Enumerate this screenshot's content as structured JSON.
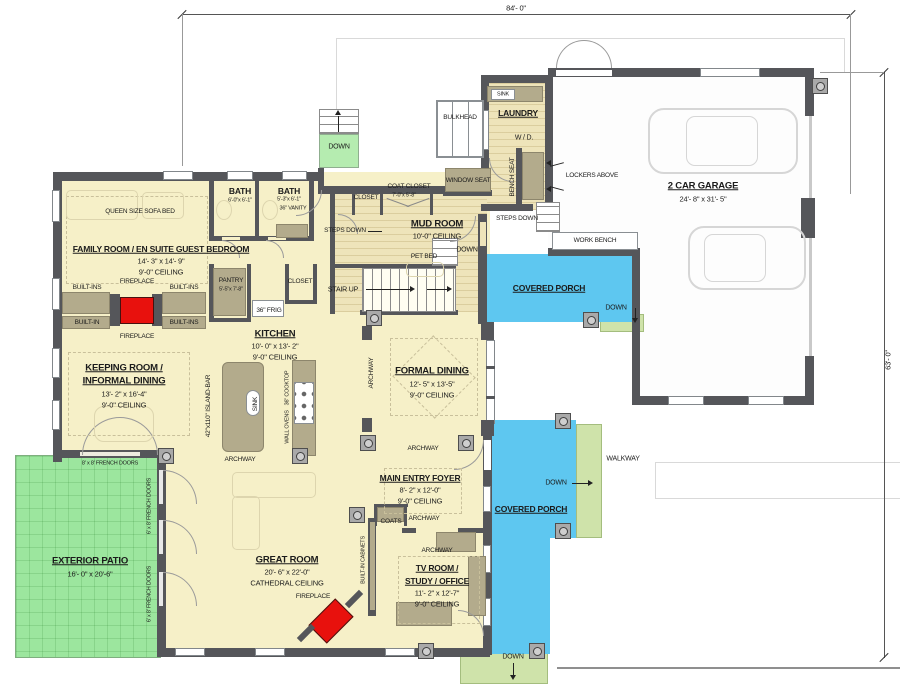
{
  "colors": {
    "floor": "#f6f0c8",
    "mudf": "#eee4ba",
    "wall": "#55565a",
    "cab": "#b3ab8c",
    "patio": "#9ce69e",
    "walk": "#cfe3aa",
    "topstair": "#b5ecb0",
    "porch": "#5ec7f0",
    "red": "#e8110d",
    "carline": "#d6d6d6"
  },
  "labels": {
    "dim_width": "84'- 0\"",
    "dim_height": "63'- 0\"",
    "down": "DOWN",
    "bulkhead": "BULKHEAD",
    "sink": "SINK",
    "laundry": "LAUNDRY",
    "wd": "W / D.",
    "bench_seat": "BENCH SEAT",
    "lockers_above": "LOCKERS ABOVE",
    "garage_title": "2 CAR GARAGE",
    "garage_size": "24'- 8\" x 31'- 5\"",
    "work_bench": "WORK BENCH",
    "steps_down": "STEPS DOWN",
    "window_seat": "WINDOW SEAT",
    "coat_closet": "COAT CLOSET",
    "coat_closet_size": "7'-0\"x 5'-8\"",
    "closet": "CLOSET",
    "mud_title": "MUD ROOM",
    "mud_ceiling": "10'-0\" CEILING",
    "pet_bed": "PET BED",
    "stair_up": "STAIR UP",
    "queen_sofa": "QUEEN SIZE SOFA BED",
    "bath": "BATH",
    "bath1_size": "6'-0\"x 6'-1\"",
    "bath2_size": "5'-3\"x 6'-1\"",
    "vanity": "36\" VANITY",
    "family_title": "FAMILY ROOM / EN SUITE GUEST BEDROOM",
    "family_size": "14'- 3\" x 14'- 9\"",
    "ceiling_9": "9'-0\" CEILING",
    "built_ins": "BUILT-INS",
    "built_in": "BUILT-IN",
    "fireplace": "FIREPLACE",
    "pantry": "PANTRY",
    "pantry_size": "5'-5\"x 7'-8\"",
    "frig": "36\" FRIG",
    "kitchen_title": "KITCHEN",
    "kitchen_size": "10'- 0\" x 13'- 2\"",
    "island": "42\"x110\" ISLAND-BAR",
    "island_sink": "SINK",
    "cooktop": "36\" COOKTOP",
    "wall_ovens": "WALL OVENS",
    "keeping_title1": "KEEPING ROOM /",
    "keeping_title2": "INFORMAL DINING",
    "keeping_size": "13'- 2\" x 16'-4\"",
    "archway": "ARCHWAY",
    "formal_title": "FORMAL DINING",
    "formal_size": "12'- 5\" x 13'-5\"",
    "foyer_title": "MAIN ENTRY FOYER",
    "foyer_size": "8'- 2\" x 12'-0\"",
    "coats": "COATS",
    "great_title": "GREAT ROOM",
    "great_size": "20'- 6\" x 22'-0\"",
    "cathedral": "CATHEDRAL CEILING",
    "builtin_cab": "BUILT-IN CABINETS",
    "tv_title1": "TV ROOM /",
    "tv_title2": "STUDY / OFFICE",
    "tv_size": "11'- 2\" x 12'-7\"",
    "patio_title": "EXTERIOR PATIO",
    "patio_size": "16'- 0\" x 20'-6\"",
    "french_8x8": "8' x 8' FRENCH DOORS",
    "french_6x8": "6' x 8' FRENCH DOORS",
    "covered_porch": "COVERED PORCH",
    "walkway": "WALKWAY"
  }
}
